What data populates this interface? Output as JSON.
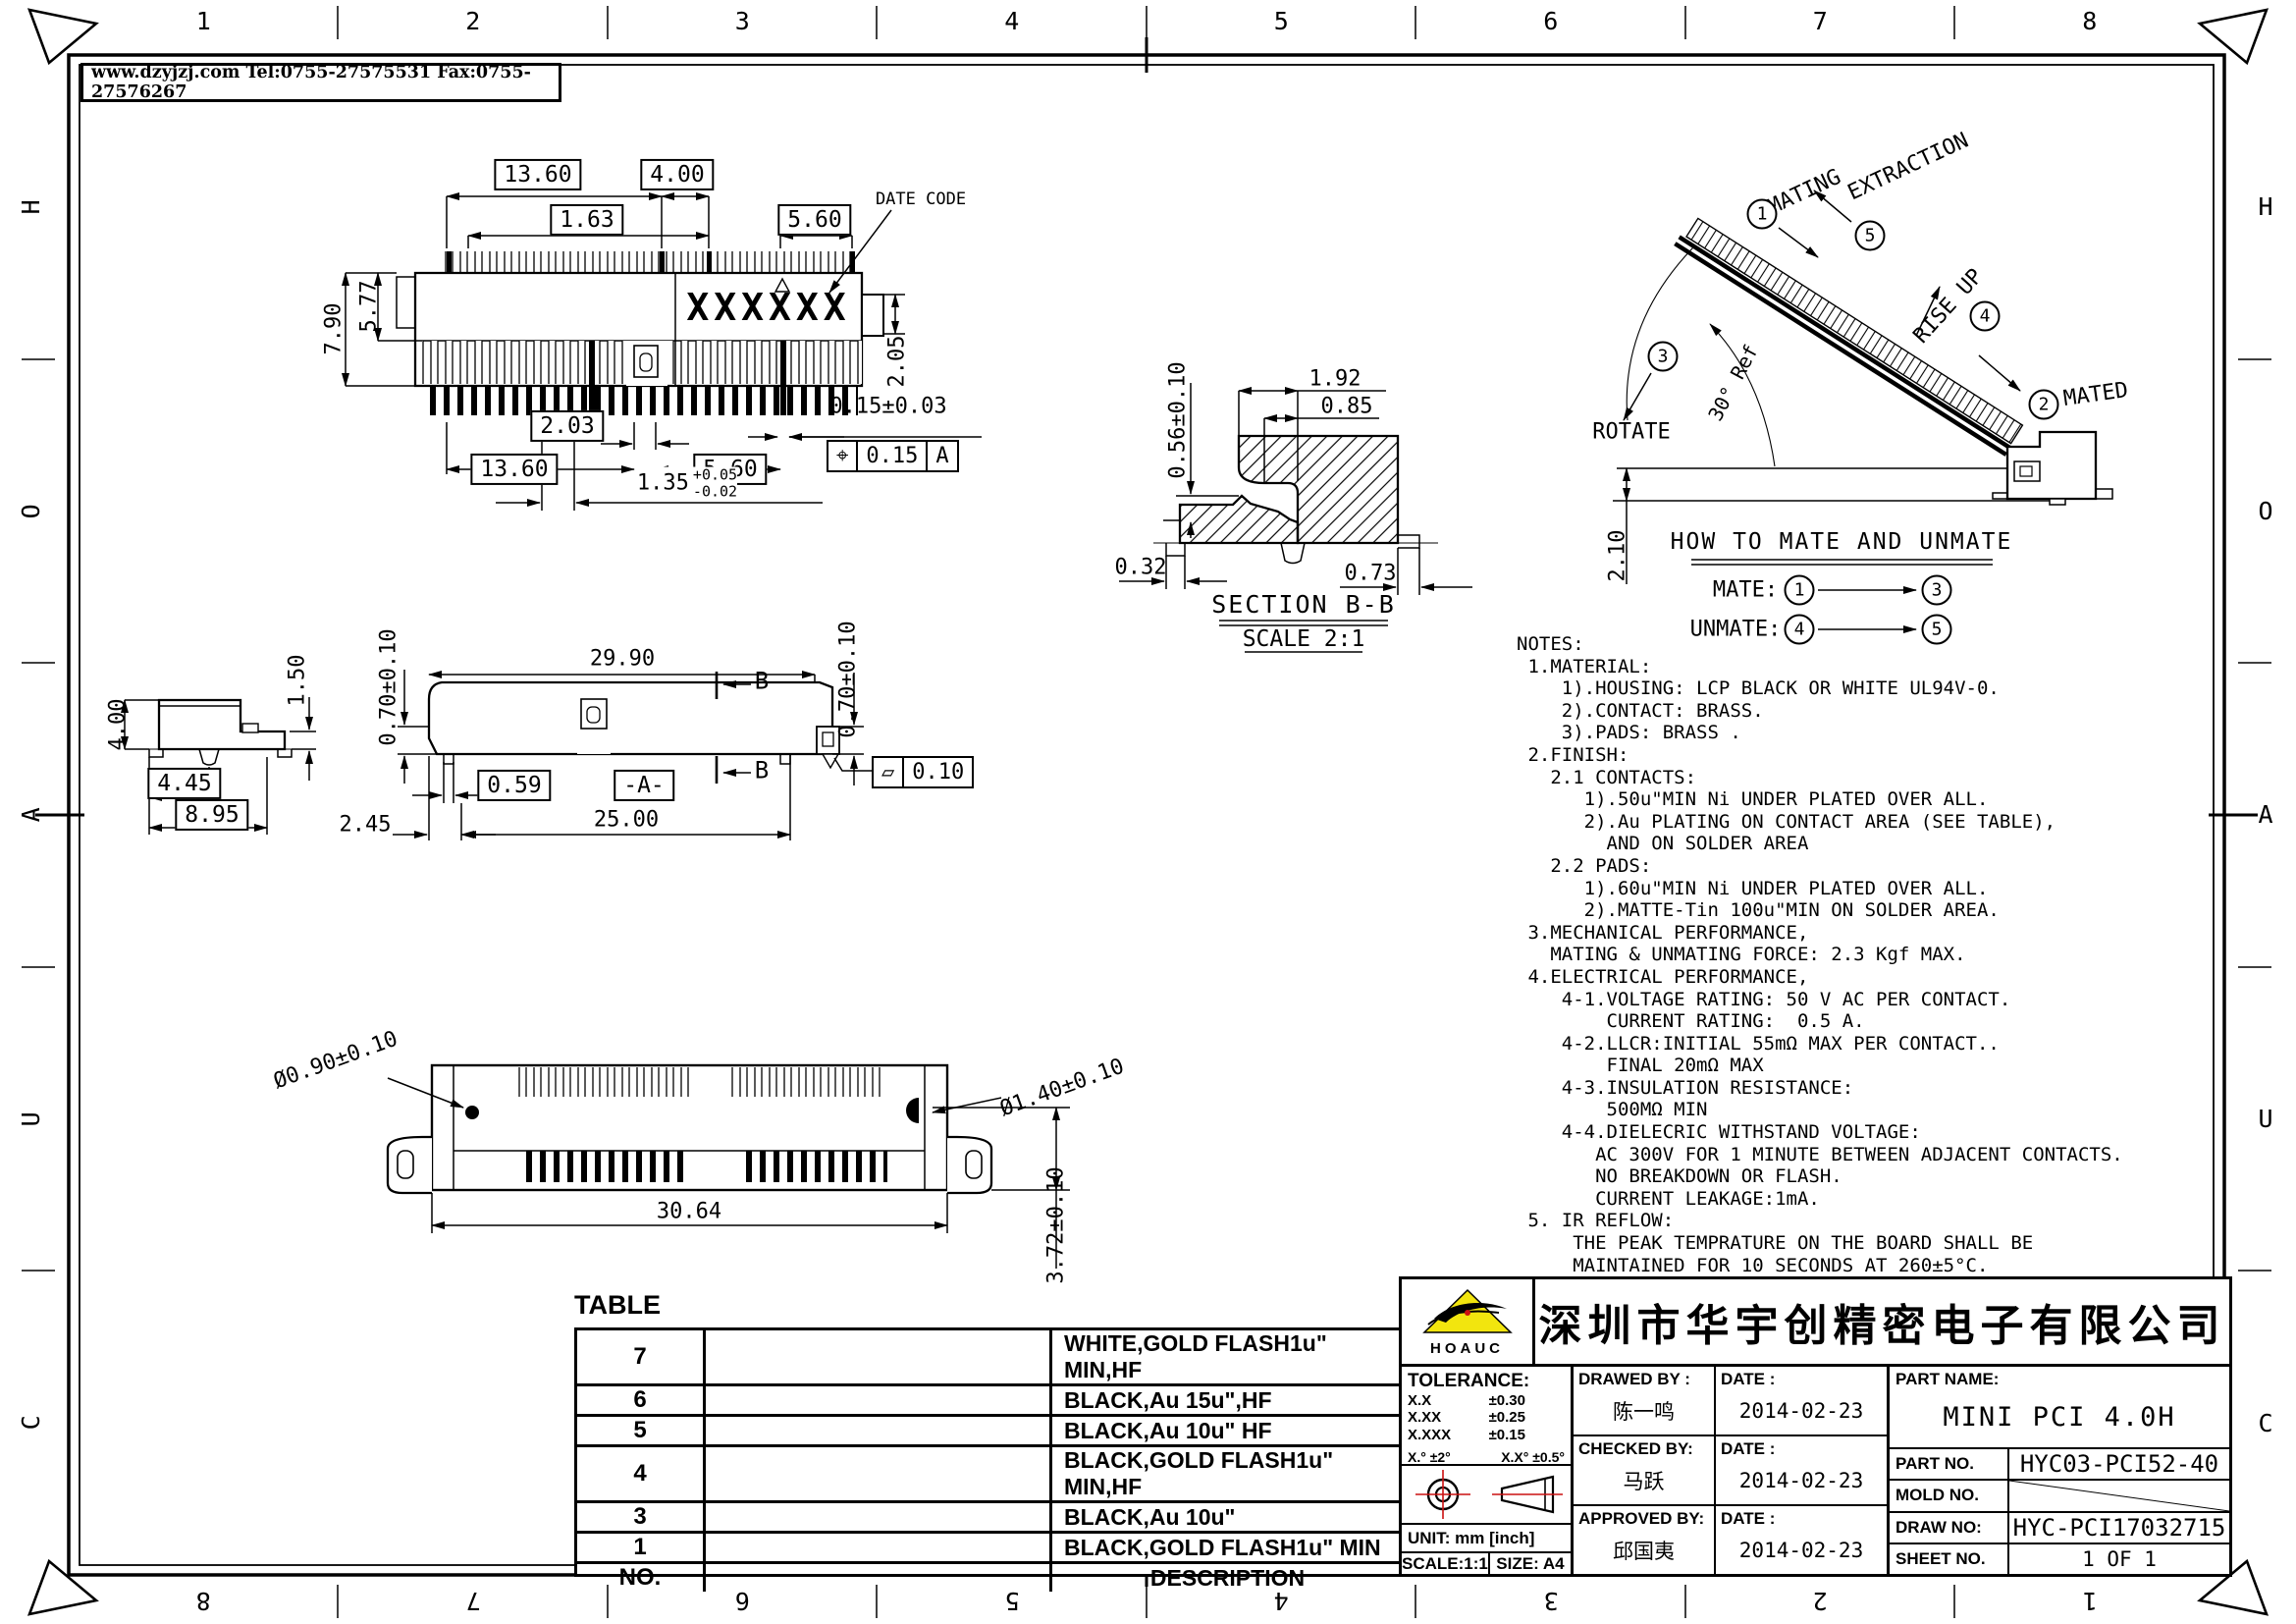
{
  "colors": {
    "logo_yellow": "#f2e50e",
    "accent_red": "#cc1111"
  },
  "header": {
    "contact": "www.dzyjzj.com  Tel:0755-27575531  Fax:0755-27576267"
  },
  "zones": {
    "top": [
      "1",
      "2",
      "3",
      "4",
      "5",
      "6",
      "7",
      "8"
    ],
    "bottom": [
      "8",
      "7",
      "6",
      "5",
      "4",
      "3",
      "2",
      "1"
    ],
    "left": [
      "H",
      "O",
      "A",
      "U",
      "C"
    ],
    "right": [
      "H",
      "O",
      "A",
      "U",
      "C"
    ]
  },
  "top_view": {
    "marking": "XXXXXX",
    "date_code": "DATE CODE",
    "dims": {
      "t1": "13.60",
      "t2": "4.00",
      "t3": "1.63",
      "t4": "5.60",
      "l1": "7.90",
      "l2": "5.77",
      "r1": "2.05",
      "b1": "2.03",
      "b2": "13.60",
      "b3": "5.60",
      "b4": "0.15±0.03",
      "b5": "1.35",
      "b5_hi": "+0.05",
      "b5_lo": "-0.02"
    },
    "fcf": {
      "sym": "⌖",
      "val": "0.15",
      "datum": "A"
    }
  },
  "section_bb": {
    "title": "SECTION B-B",
    "scale": "SCALE 2:1",
    "dims": {
      "d1": "0.56±0.10",
      "d2": "1.92",
      "d3": "0.85",
      "d4": "0.32",
      "d5": "0.73"
    }
  },
  "mate": {
    "labels": {
      "mating": "MATING",
      "extraction": "EXTRACTION",
      "rise_up": "RISE UP",
      "mated": "MATED",
      "rotate": "ROTATE",
      "angle_ref": "30° Ref",
      "gap": "2.10"
    },
    "steps": [
      "1",
      "2",
      "3",
      "4",
      "5"
    ],
    "how_title": "HOW TO MATE AND UNMATE",
    "mate_label": "MATE:",
    "unmate_label": "UNMATE:"
  },
  "side_view": {
    "dims": {
      "h": "4.00",
      "step": "1.50",
      "w1": "4.45",
      "w2": "8.95"
    }
  },
  "front_view": {
    "dims": {
      "w": "29.90",
      "hl": "0.70±0.10",
      "hr": "0.70±0.10",
      "foot": "0.59",
      "off": "2.45",
      "span": "25.00",
      "flat": "0.10"
    },
    "datum": "-A-",
    "sec": "B"
  },
  "bottom_view": {
    "dims": {
      "hole": "Ø0.90±0.10",
      "post": "Ø1.40±0.10",
      "w": "30.64",
      "h": "3.72±0.10"
    }
  },
  "notes": {
    "lines": [
      "NOTES:",
      " 1.MATERIAL:",
      "    1).HOUSING: LCP BLACK OR WHITE UL94V-0.",
      "    2).CONTACT: BRASS.",
      "    3).PADS: BRASS .",
      " 2.FINISH:",
      "   2.1 CONTACTS:",
      "      1).50u\"MIN Ni UNDER PLATED OVER ALL.",
      "      2).Au PLATING ON CONTACT AREA (SEE TABLE),",
      "        AND ON SOLDER AREA",
      "   2.2 PADS:",
      "      1).60u\"MIN Ni UNDER PLATED OVER ALL.",
      "      2).MATTE-Tin 100u\"MIN ON SOLDER AREA.",
      " 3.MECHANICAL PERFORMANCE,",
      "   MATING & UNMATING FORCE: 2.3 Kgf MAX.",
      " 4.ELECTRICAL PERFORMANCE,",
      "    4-1.VOLTAGE RATING: 50 V AC PER CONTACT.",
      "        CURRENT RATING:  0.5 A.",
      "    4-2.LLCR:INITIAL 55mΩ MAX PER CONTACT..",
      "        FINAL 20mΩ MAX",
      "    4-3.INSULATION RESISTANCE:",
      "        500MΩ MIN",
      "    4-4.DIELECRIC WITHSTAND VOLTAGE:",
      "       AC 300V FOR 1 MINUTE BETWEEN ADJACENT CONTACTS.",
      "       NO BREAKDOWN OR FLASH.",
      "       CURRENT LEAKAGE:1mA.",
      " 5. IR REFLOW:",
      "     THE PEAK TEMPRATURE ON THE BOARD SHALL BE",
      "     MAINTAINED FOR 10 SECONDS AT 260±5°C."
    ]
  },
  "table": {
    "title": "TABLE",
    "rows": [
      {
        "no": "7",
        "desc": "WHITE,GOLD FLASH1u\" MIN,HF"
      },
      {
        "no": "6",
        "desc": "BLACK,Au 15u\",HF"
      },
      {
        "no": "5",
        "desc": "BLACK,Au 10u\" HF"
      },
      {
        "no": "4",
        "desc": "BLACK,GOLD FLASH1u\" MIN,HF"
      },
      {
        "no": "3",
        "desc": "BLACK,Au 10u\""
      },
      {
        "no": "1",
        "desc": "BLACK,GOLD FLASH1u\" MIN"
      },
      {
        "no": "NO.",
        "desc": "DESCRIPTION"
      }
    ]
  },
  "title_block": {
    "company": "深圳市华宇创精密电子有限公司",
    "logo_text": "HOAUC",
    "tolerance": {
      "title": "TOLERANCE:",
      "r1l": "X.X",
      "r1v": "±0.30",
      "r2l": "X.XX",
      "r2v": "±0.25",
      "r3l": "X.XXX",
      "r3v": "±0.15",
      "a1": "X.°  ±2°",
      "a2": "X.X°  ±0.5°"
    },
    "unit": "UNIT:  mm  [inch]",
    "scale": "SCALE:1:1",
    "size": "SIZE:  A4",
    "people": [
      {
        "label": "DRAWED BY :",
        "name": "陈一鸣",
        "date_label": "DATE :",
        "date": "2014-02-23"
      },
      {
        "label": "CHECKED BY:",
        "name": "马跃",
        "date_label": "DATE :",
        "date": "2014-02-23"
      },
      {
        "label": "APPROVED BY:",
        "name": "邱国夷",
        "date_label": "DATE :",
        "date": "2014-02-23"
      }
    ],
    "part_name_label": "PART NAME:",
    "part_name": "MINI PCI 4.0H",
    "part_no_label": "PART NO.",
    "part_no": "HYC03-PCI52-40",
    "mold_no_label": "MOLD NO.",
    "mold_no": "",
    "draw_no_label": "DRAW NO:",
    "draw_no": "HYC-PCI17032715",
    "sheet_no_label": "SHEET NO.",
    "sheet_no": "1 OF 1"
  }
}
